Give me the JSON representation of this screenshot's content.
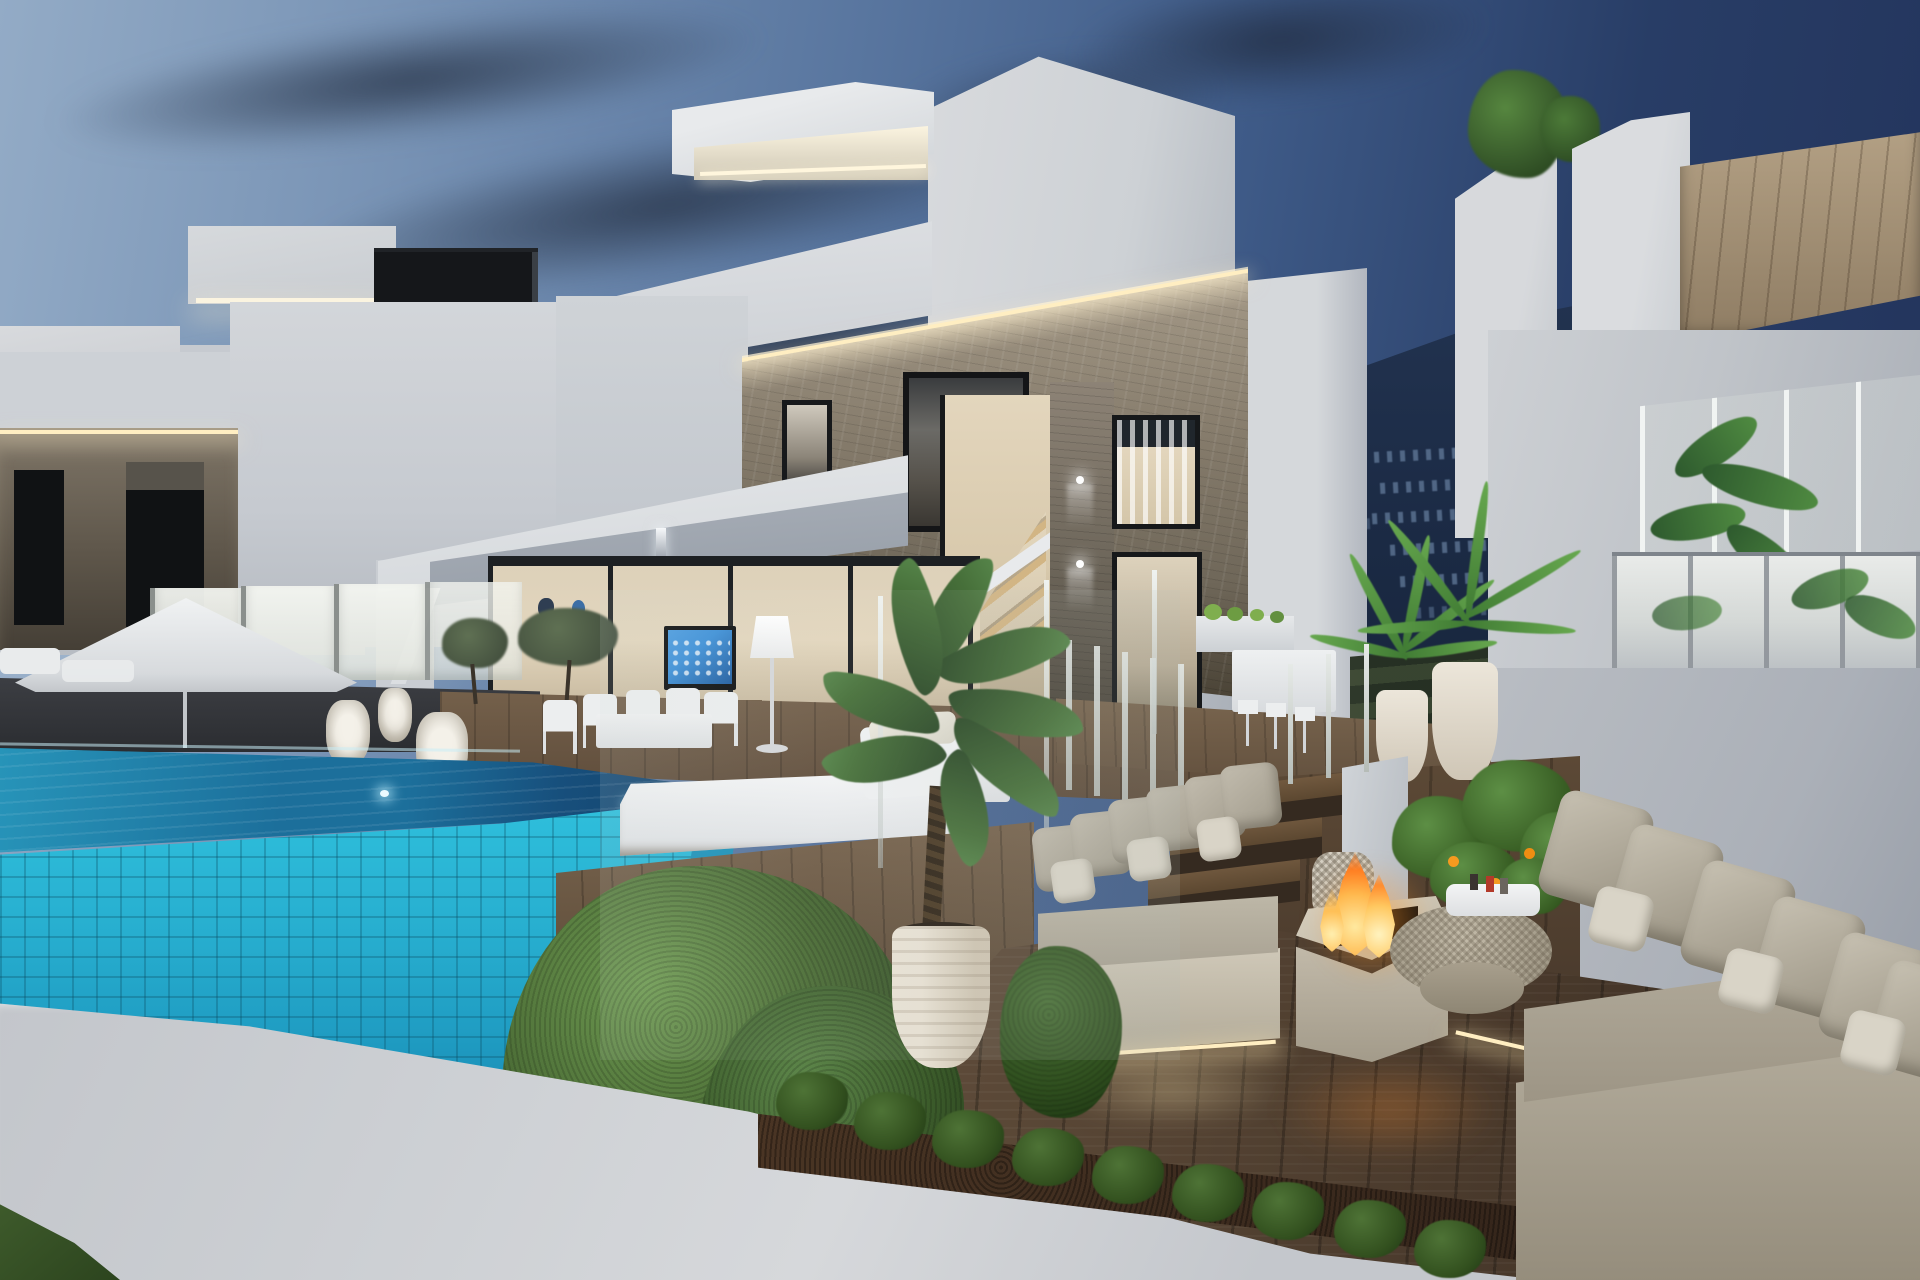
{
  "scene": {
    "type": "3d-architectural-rendering",
    "caption": "Dusk exterior rendering of a modern white two-storey villa development with stone-clad facades, warm LED cove lighting, an infinity pool with turquoise mosaic tiles, wooden decks, outdoor lounge furniture, a burning fire pit table and landscaped hedges, set against a mountain with hillside apartment lights",
    "time_of_day": "dusk",
    "setting": "hillside coastal residential development"
  },
  "palette": {
    "sky_light": "#93abc6",
    "sky_mid": "#5a77a0",
    "sky_deep": "#22325a",
    "cloud_dark": "#33445c",
    "cloud_light": "#96aac0",
    "mountain_top": "#223350",
    "mountain_deep": "#152238",
    "mountain_window": "#8caacd",
    "wall_bright": "#e8eaec",
    "wall_white": "#d6d9dc",
    "wall_mid": "#c0c5cb",
    "wall_shadow": "#9aa1ab",
    "wall_dark": "#70767f",
    "stone_light": "#a79c8a",
    "stone_mid": "#6f6759",
    "stone_dark": "#474033",
    "wood_light": "#b3a084",
    "wood_dark": "#8e7c63",
    "led_warm": "#ffeec2",
    "led_pale": "#fbf4e0",
    "glass_frost": "#eeefe9",
    "interior_warm": "#e3d6bd",
    "interior_deep": "#8d8373",
    "frame_dark": "#1d2023",
    "tv_blue": "#3b8fd8",
    "pool_aqua": "#2fc0dd",
    "pool_teal": "#1f9cc2",
    "pool_mid": "#1c6f9b",
    "pool_deep": "#143f66",
    "deck_light": "#77634d",
    "deck_mid": "#5f4c3a",
    "deck_dark": "#3a2d22",
    "hedge_light": "#6f9b52",
    "hedge_mid": "#4a6b35",
    "hedge_dark": "#2d4621",
    "soil_brown": "#4a3524",
    "sofa_light": "#c7c1b2",
    "sofa_mid": "#aca595",
    "sofa_deep": "#8f8878",
    "cushion_pale": "#d9d4c7",
    "fire_core": "#ffe9a0",
    "fire_mid": "#ffb84d",
    "fire_deep": "#ff7e22",
    "pot_light": "#e9e2d4",
    "pot_mid": "#cfc5b2",
    "leaf_dark": "#2c4a28",
    "leaf_mid": "#47703a",
    "leaf_bright": "#5d8f45",
    "orange_fruit": "#f59a1f",
    "wicker_gray": "#cdc7ba",
    "grass_green": "#3f5c2c"
  },
  "objects": [
    "dusk sky with dark streaked clouds",
    "mountain ridge with lit hillside apartment blocks",
    "three modern white cubist villas",
    "stone-clad facades with warm LED cove lighting",
    "rooftop light boxes with under-glow",
    "interior staircase behind floor-to-ceiling glazing",
    "living room with wall-mounted smart TV and glowing floor lamp",
    "outdoor dining table with white chairs",
    "white patio umbrella and sun loungers",
    "white wicker lanterns",
    "frosted glass pool fence",
    "infinity pool with turquoise mosaic tile wall and underwater lights",
    "wooden pool deck and platform",
    "white double day bed with cushions and side table",
    "potted alocasia plant in ribbed white pot",
    "trimmed boxwood hedges and planting bed",
    "grey outdoor sofas with scatter cushions and LED under-lighting",
    "wooden steps with glass balustrade",
    "square fire pit table with burning flames",
    "round wicker coffee table with potted citrus tree and serving tray",
    "potted palm plants and outdoor kitchen with bar stools",
    "glass balustrades with tropical plants",
    "white perimeter wall and grass verge"
  ]
}
